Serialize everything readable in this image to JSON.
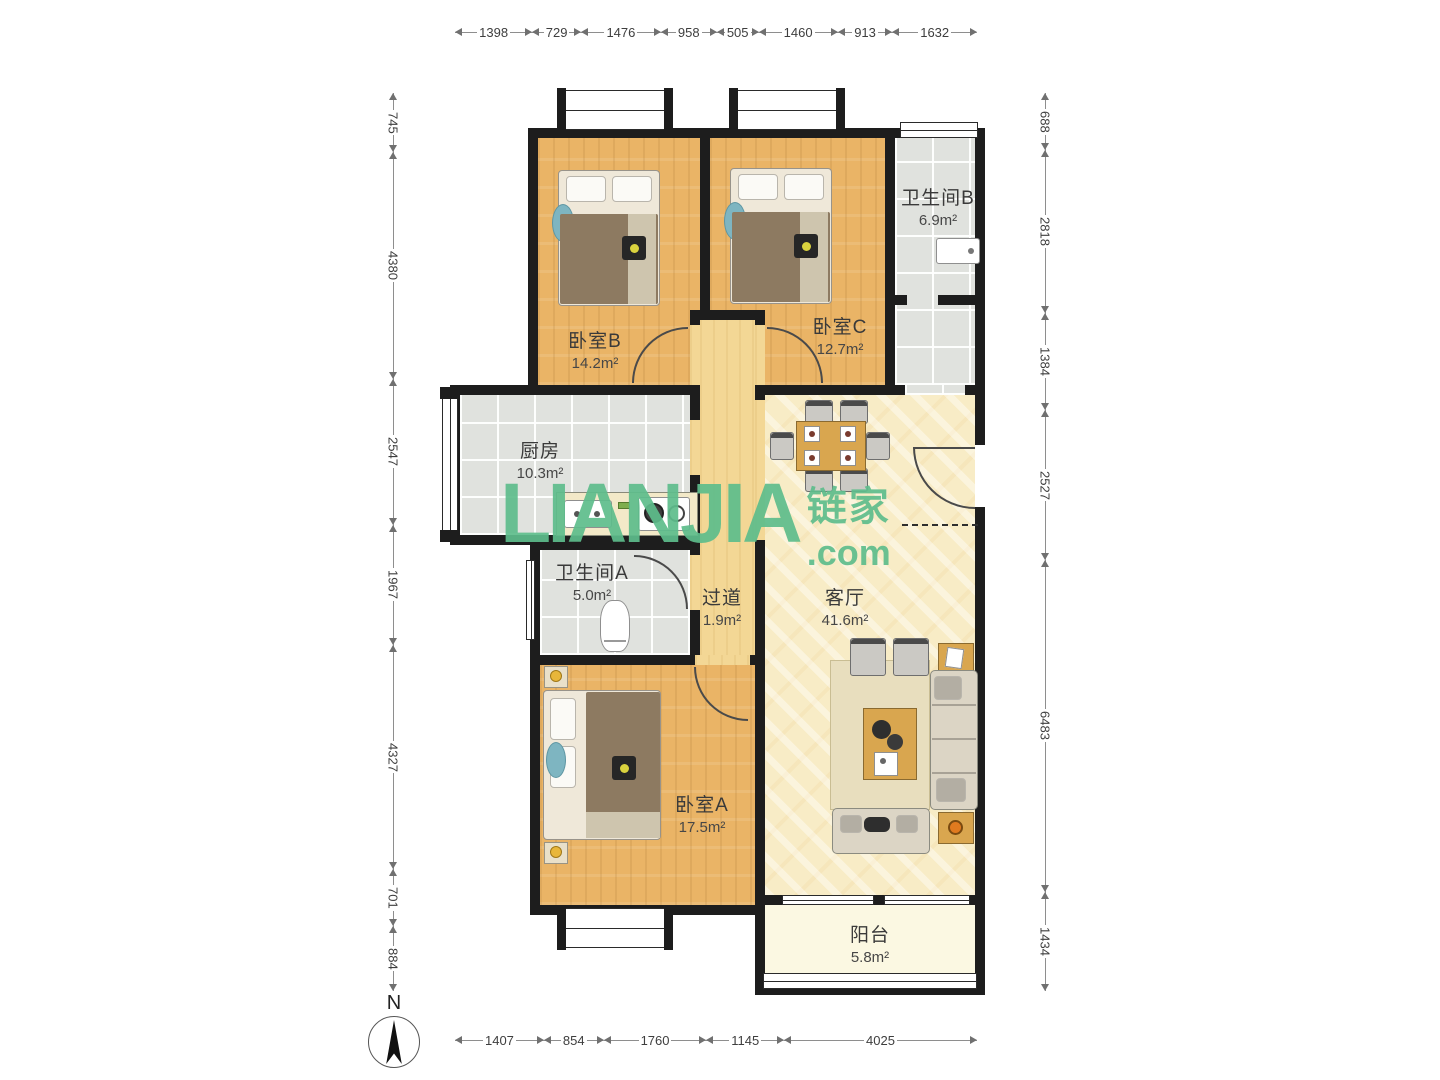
{
  "brand": {
    "logo_text": "LIANJIA",
    "logo_cn": "链家",
    "logo_suffix": ".com"
  },
  "compass": {
    "label": "N"
  },
  "dimensions": {
    "top": [
      "1398",
      "729",
      "1476",
      "958",
      "505",
      "1460",
      "913",
      "1632"
    ],
    "bottom": [
      "1407",
      "854",
      "1760",
      "1145",
      "4025"
    ],
    "left": [
      "745",
      "4380",
      "2547",
      "1967",
      "4327",
      "701",
      "884"
    ],
    "right": [
      "688",
      "2818",
      "1384",
      "2527",
      "6483",
      "1434"
    ]
  },
  "rooms": {
    "bedroom_b": {
      "name": "卧室B",
      "area": "14.2m²"
    },
    "bedroom_c": {
      "name": "卧室C",
      "area": "12.7m²"
    },
    "bathroom_b": {
      "name": "卫生间B",
      "area": "6.9m²"
    },
    "kitchen": {
      "name": "厨房",
      "area": "10.3m²"
    },
    "hallway": {
      "name": "过道",
      "area": "1.9m²"
    },
    "bathroom_a": {
      "name": "卫生间A",
      "area": "5.0m²"
    },
    "living_room": {
      "name": "客厅",
      "area": "41.6m²"
    },
    "bedroom_a": {
      "name": "卧室A",
      "area": "17.5m²"
    },
    "balcony": {
      "name": "阳台",
      "area": "5.8m²"
    }
  },
  "colors": {
    "wall": "#1d1d1d",
    "wood": "#EAB466",
    "hall_wood": "#F3D795",
    "marble": "#F8ECC6",
    "tile": "#E0E2DE",
    "balcony": "#FBF8E2",
    "watermark_green": "#5EBD8C"
  }
}
